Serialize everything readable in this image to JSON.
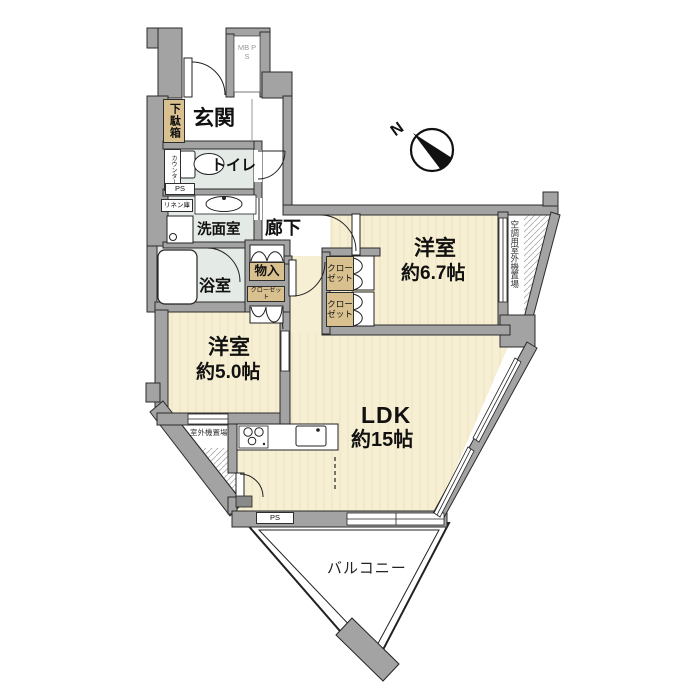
{
  "colors": {
    "wall": "#a3a3a3",
    "room_cream": "#f7efd3",
    "wet_room": "#e4eae5",
    "closet_tan": "#d9c08f",
    "outline": "#2b2b2b"
  },
  "rooms": {
    "ldk": {
      "name": "LDK",
      "size": "約15帖"
    },
    "western_a": {
      "name": "洋室",
      "size": "約6.7帖"
    },
    "western_b": {
      "name": "洋室",
      "size": "約5.0帖"
    },
    "genkan": {
      "name": "玄関"
    },
    "hallway": {
      "name": "廊下"
    },
    "toilet": {
      "name": "トイレ"
    },
    "washroom": {
      "name": "洗面室"
    },
    "bathroom": {
      "name": "浴室"
    },
    "balcony": {
      "name": "バルコニー"
    }
  },
  "storage": {
    "shoe_cabinet": "下駄箱",
    "storage_in": "物入",
    "closet_small": "クローゼット",
    "closet_a": "クローゼット",
    "closet_b": "クローゼット",
    "linen": "リネン庫",
    "counter": "カウンター"
  },
  "service": {
    "ps_upper": "PS",
    "ps_lower": "PS",
    "mb_ps": "MB PS",
    "aircon_space": "空調用室外機置場",
    "outdoor_unit": "室外機置場"
  },
  "compass": {
    "north": "N"
  }
}
